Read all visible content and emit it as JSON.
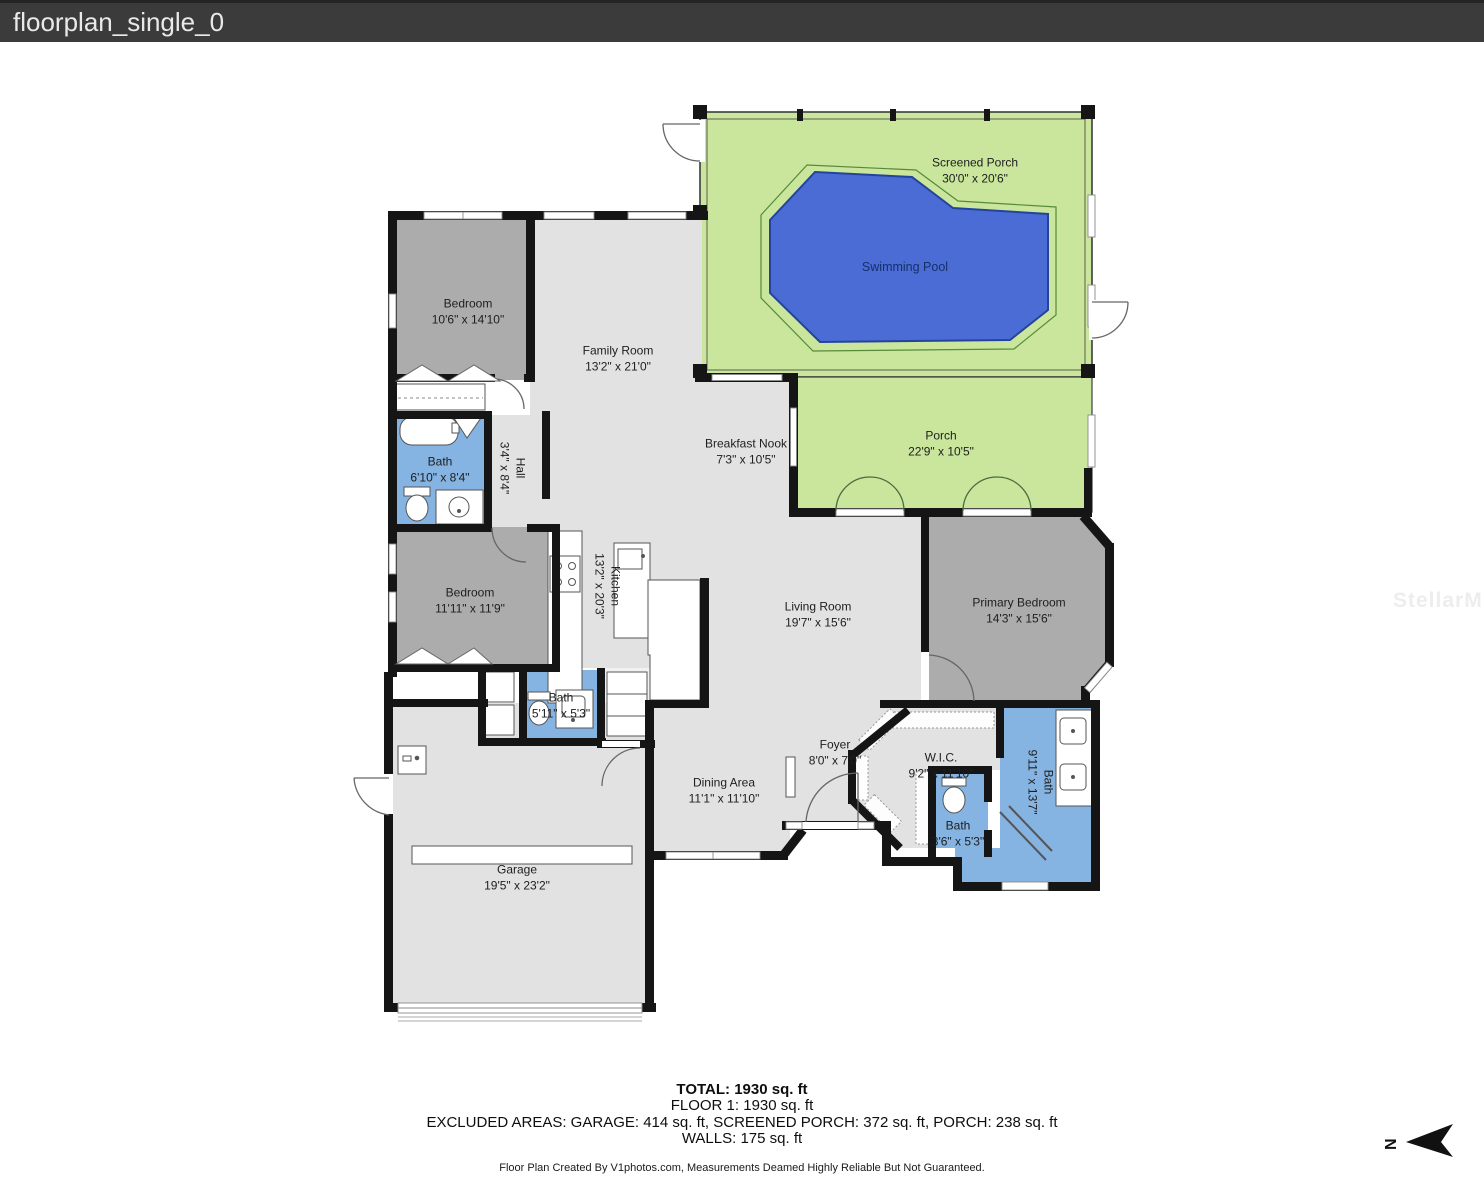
{
  "header": {
    "title": "floorplan_single_0"
  },
  "watermark": "StellarMLS",
  "compass": {
    "label": "N"
  },
  "colors": {
    "header_bg": "#3b3b3b",
    "porch_green": "#c9e69c",
    "pool_blue": "#4a6cd4",
    "pool_outline": "#24449c",
    "bath_blue": "#85b3e2",
    "bedroom_gray": "#acacac",
    "floor_gray": "#e2e2e2",
    "wall_black": "#151515"
  },
  "rooms": {
    "screened_porch": {
      "name": "Screened Porch",
      "dims": "30'0\" x 20'6\""
    },
    "swimming_pool": {
      "name": "Swimming Pool"
    },
    "porch": {
      "name": "Porch",
      "dims": "22'9\" x 10'5\""
    },
    "breakfast_nook": {
      "name": "Breakfast Nook",
      "dims": "7'3\" x 10'5\""
    },
    "bedroom_top": {
      "name": "Bedroom",
      "dims": "10'6\" x 14'10\""
    },
    "family_room": {
      "name": "Family Room",
      "dims": "13'2\" x 21'0\""
    },
    "bath_1": {
      "name": "Bath",
      "dims": "6'10\" x 8'4\""
    },
    "hall": {
      "name": "Hall",
      "dims": "3'4\" x 8'4\""
    },
    "bedroom_mid": {
      "name": "Bedroom",
      "dims": "11'11\" x 11'9\""
    },
    "kitchen": {
      "name": "Kitchen",
      "dims": "13'2\" x 20'3\""
    },
    "living_room": {
      "name": "Living Room",
      "dims": "19'7\" x 15'6\""
    },
    "primary_bedroom": {
      "name": "Primary Bedroom",
      "dims": "14'3\" x 15'6\""
    },
    "bath_2": {
      "name": "Bath",
      "dims": "5'11\" x 5'3\""
    },
    "dining_area": {
      "name": "Dining Area",
      "dims": "11'1\" x 11'10\""
    },
    "foyer": {
      "name": "Foyer",
      "dims": "8'0\" x 7'0\""
    },
    "wic": {
      "name": "W.I.C.",
      "dims": "9'2\" x 11'10\""
    },
    "bath_primary": {
      "name": "Bath",
      "dims": "9'11\" x 13'7\""
    },
    "bath_small": {
      "name": "Bath",
      "dims": "3'6\" x 5'3\""
    },
    "garage": {
      "name": "Garage",
      "dims": "19'5\" x 23'2\""
    }
  },
  "summary": {
    "total": "TOTAL: 1930 sq. ft",
    "floor1": "FLOOR 1: 1930 sq. ft",
    "excluded": "EXCLUDED AREAS: GARAGE: 414 sq. ft, SCREENED PORCH: 372 sq. ft, PORCH: 238 sq. ft",
    "walls": "WALLS: 175 sq. ft",
    "credit": "Floor Plan Created By V1photos.com, Measurements Deamed Highly Reliable But Not Guaranteed."
  }
}
